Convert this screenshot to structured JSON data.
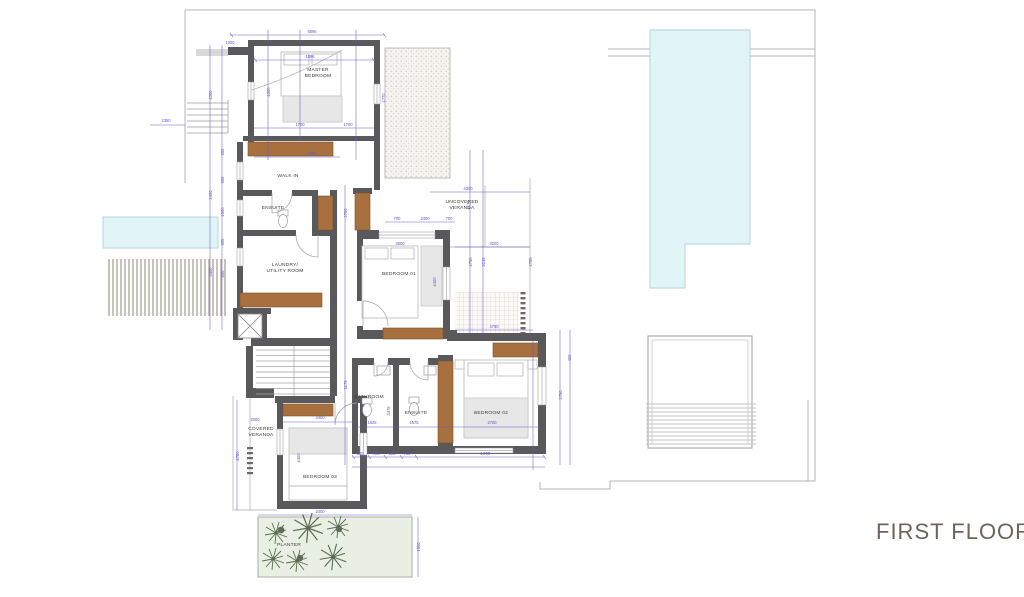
{
  "title": {
    "label": "FIRST FLOOR"
  },
  "colors": {
    "wall": "#59595c",
    "wardrobe_wood": "#a8703e",
    "dimension": "#6156c8",
    "pool": "#e1f5f9",
    "planter": "#e9f0e3",
    "plant": "#5a6b52",
    "title_text": "#6f6459"
  },
  "rooms": [
    {
      "id": "master-bedroom",
      "lines": [
        "MASTER",
        "BEDROOM"
      ],
      "x": 318,
      "y": 71
    },
    {
      "id": "walk-in",
      "lines": [
        "WALK IN"
      ],
      "x": 288,
      "y": 177
    },
    {
      "id": "ensuite-upper",
      "lines": [
        "ENSUITE"
      ],
      "x": 273,
      "y": 209
    },
    {
      "id": "laundry",
      "lines": [
        "LAUNDRY/",
        "UTILITY ROOM"
      ],
      "x": 285,
      "y": 266
    },
    {
      "id": "uncovered-veranda",
      "lines": [
        "UNCOVERED",
        "VERANDA"
      ],
      "x": 462,
      "y": 203
    },
    {
      "id": "bedroom-01",
      "lines": [
        "BEDROOM 01"
      ],
      "x": 399,
      "y": 275
    },
    {
      "id": "bathroom",
      "lines": [
        "BATHROOM"
      ],
      "x": 369,
      "y": 398
    },
    {
      "id": "ensuite-lower",
      "lines": [
        "ENSUITE"
      ],
      "x": 416,
      "y": 414
    },
    {
      "id": "bedroom-02",
      "lines": [
        "BEDROOM 02"
      ],
      "x": 491,
      "y": 414
    },
    {
      "id": "covered-veranda",
      "lines": [
        "COVERED",
        "VERANDA"
      ],
      "x": 261,
      "y": 430
    },
    {
      "id": "bedroom-03",
      "lines": [
        "BEDROOM 03"
      ],
      "x": 320,
      "y": 478
    },
    {
      "id": "planter",
      "lines": [
        "PLANTER"
      ],
      "x": 289,
      "y": 546
    }
  ],
  "dims": [
    {
      "t": "5896",
      "x": 312,
      "y": 33,
      "r": 0
    },
    {
      "t": "1000",
      "x": 230,
      "y": 44,
      "r": 0
    },
    {
      "t": "1896",
      "x": 310,
      "y": 58,
      "r": 0
    },
    {
      "t": "1700",
      "x": 300,
      "y": 126,
      "r": 0
    },
    {
      "t": "1700",
      "x": 348,
      "y": 126,
      "r": 0
    },
    {
      "t": "2050",
      "x": 312,
      "y": 155,
      "r": 0
    },
    {
      "t": "2350",
      "x": 166,
      "y": 122,
      "r": 0
    },
    {
      "t": "700",
      "x": 397,
      "y": 220,
      "r": 0
    },
    {
      "t": "2400",
      "x": 425,
      "y": 220,
      "r": 0
    },
    {
      "t": "700",
      "x": 449,
      "y": 220,
      "r": 0
    },
    {
      "t": "4300",
      "x": 468,
      "y": 190,
      "r": 0
    },
    {
      "t": "3200",
      "x": 494,
      "y": 245,
      "r": 0
    },
    {
      "t": "4790",
      "x": 494,
      "y": 328,
      "r": 0
    },
    {
      "t": "3600",
      "x": 400,
      "y": 245,
      "r": 0
    },
    {
      "t": "1625",
      "x": 372,
      "y": 424,
      "r": 0
    },
    {
      "t": "1575",
      "x": 414,
      "y": 424,
      "r": 0
    },
    {
      "t": "2700",
      "x": 492,
      "y": 424,
      "r": 0
    },
    {
      "t": "300",
      "x": 360,
      "y": 455,
      "r": 0
    },
    {
      "t": "700",
      "x": 376,
      "y": 455,
      "r": 0
    },
    {
      "t": "900",
      "x": 392,
      "y": 455,
      "r": 0
    },
    {
      "t": "700",
      "x": 407,
      "y": 455,
      "r": 0
    },
    {
      "t": "4,090",
      "x": 485,
      "y": 455,
      "r": 0
    },
    {
      "t": "3400",
      "x": 320,
      "y": 419,
      "r": 0
    },
    {
      "t": "2400",
      "x": 320,
      "y": 513,
      "r": 0
    },
    {
      "t": "2000",
      "x": 255,
      "y": 421,
      "r": 0
    },
    {
      "t": "4300",
      "x": 212,
      "y": 95,
      "r": -90
    },
    {
      "t": "2400",
      "x": 212,
      "y": 195,
      "r": -90
    },
    {
      "t": "3400",
      "x": 212,
      "y": 272,
      "r": -90
    },
    {
      "t": "650",
      "x": 224,
      "y": 152,
      "r": -90
    },
    {
      "t": "600",
      "x": 224,
      "y": 180,
      "r": -90
    },
    {
      "t": "1500",
      "x": 224,
      "y": 212,
      "r": -90
    },
    {
      "t": "600",
      "x": 224,
      "y": 242,
      "r": -90
    },
    {
      "t": "850",
      "x": 224,
      "y": 274,
      "r": -90
    },
    {
      "t": "4300",
      "x": 270,
      "y": 92,
      "r": -90
    },
    {
      "t": "1770",
      "x": 385,
      "y": 98,
      "r": -90
    },
    {
      "t": "2750",
      "x": 347,
      "y": 213,
      "r": -90
    },
    {
      "t": "3175",
      "x": 347,
      "y": 385,
      "r": -90
    },
    {
      "t": "4170",
      "x": 470,
      "y": 205,
      "r": -90
    },
    {
      "t": "4750",
      "x": 472,
      "y": 262,
      "r": -90
    },
    {
      "t": "3215",
      "x": 485,
      "y": 262,
      "r": -90
    },
    {
      "t": "4785",
      "x": 532,
      "y": 262,
      "r": -90
    },
    {
      "t": "2750",
      "x": 562,
      "y": 395,
      "r": -90
    },
    {
      "t": "400",
      "x": 571,
      "y": 358,
      "r": -90
    },
    {
      "t": "4400",
      "x": 436,
      "y": 282,
      "r": -90
    },
    {
      "t": "3475",
      "x": 390,
      "y": 411,
      "r": -90
    },
    {
      "t": "4400",
      "x": 300,
      "y": 458,
      "r": -90
    },
    {
      "t": "4780",
      "x": 239,
      "y": 456,
      "r": -90
    },
    {
      "t": "1500",
      "x": 420,
      "y": 547,
      "r": -90
    }
  ]
}
